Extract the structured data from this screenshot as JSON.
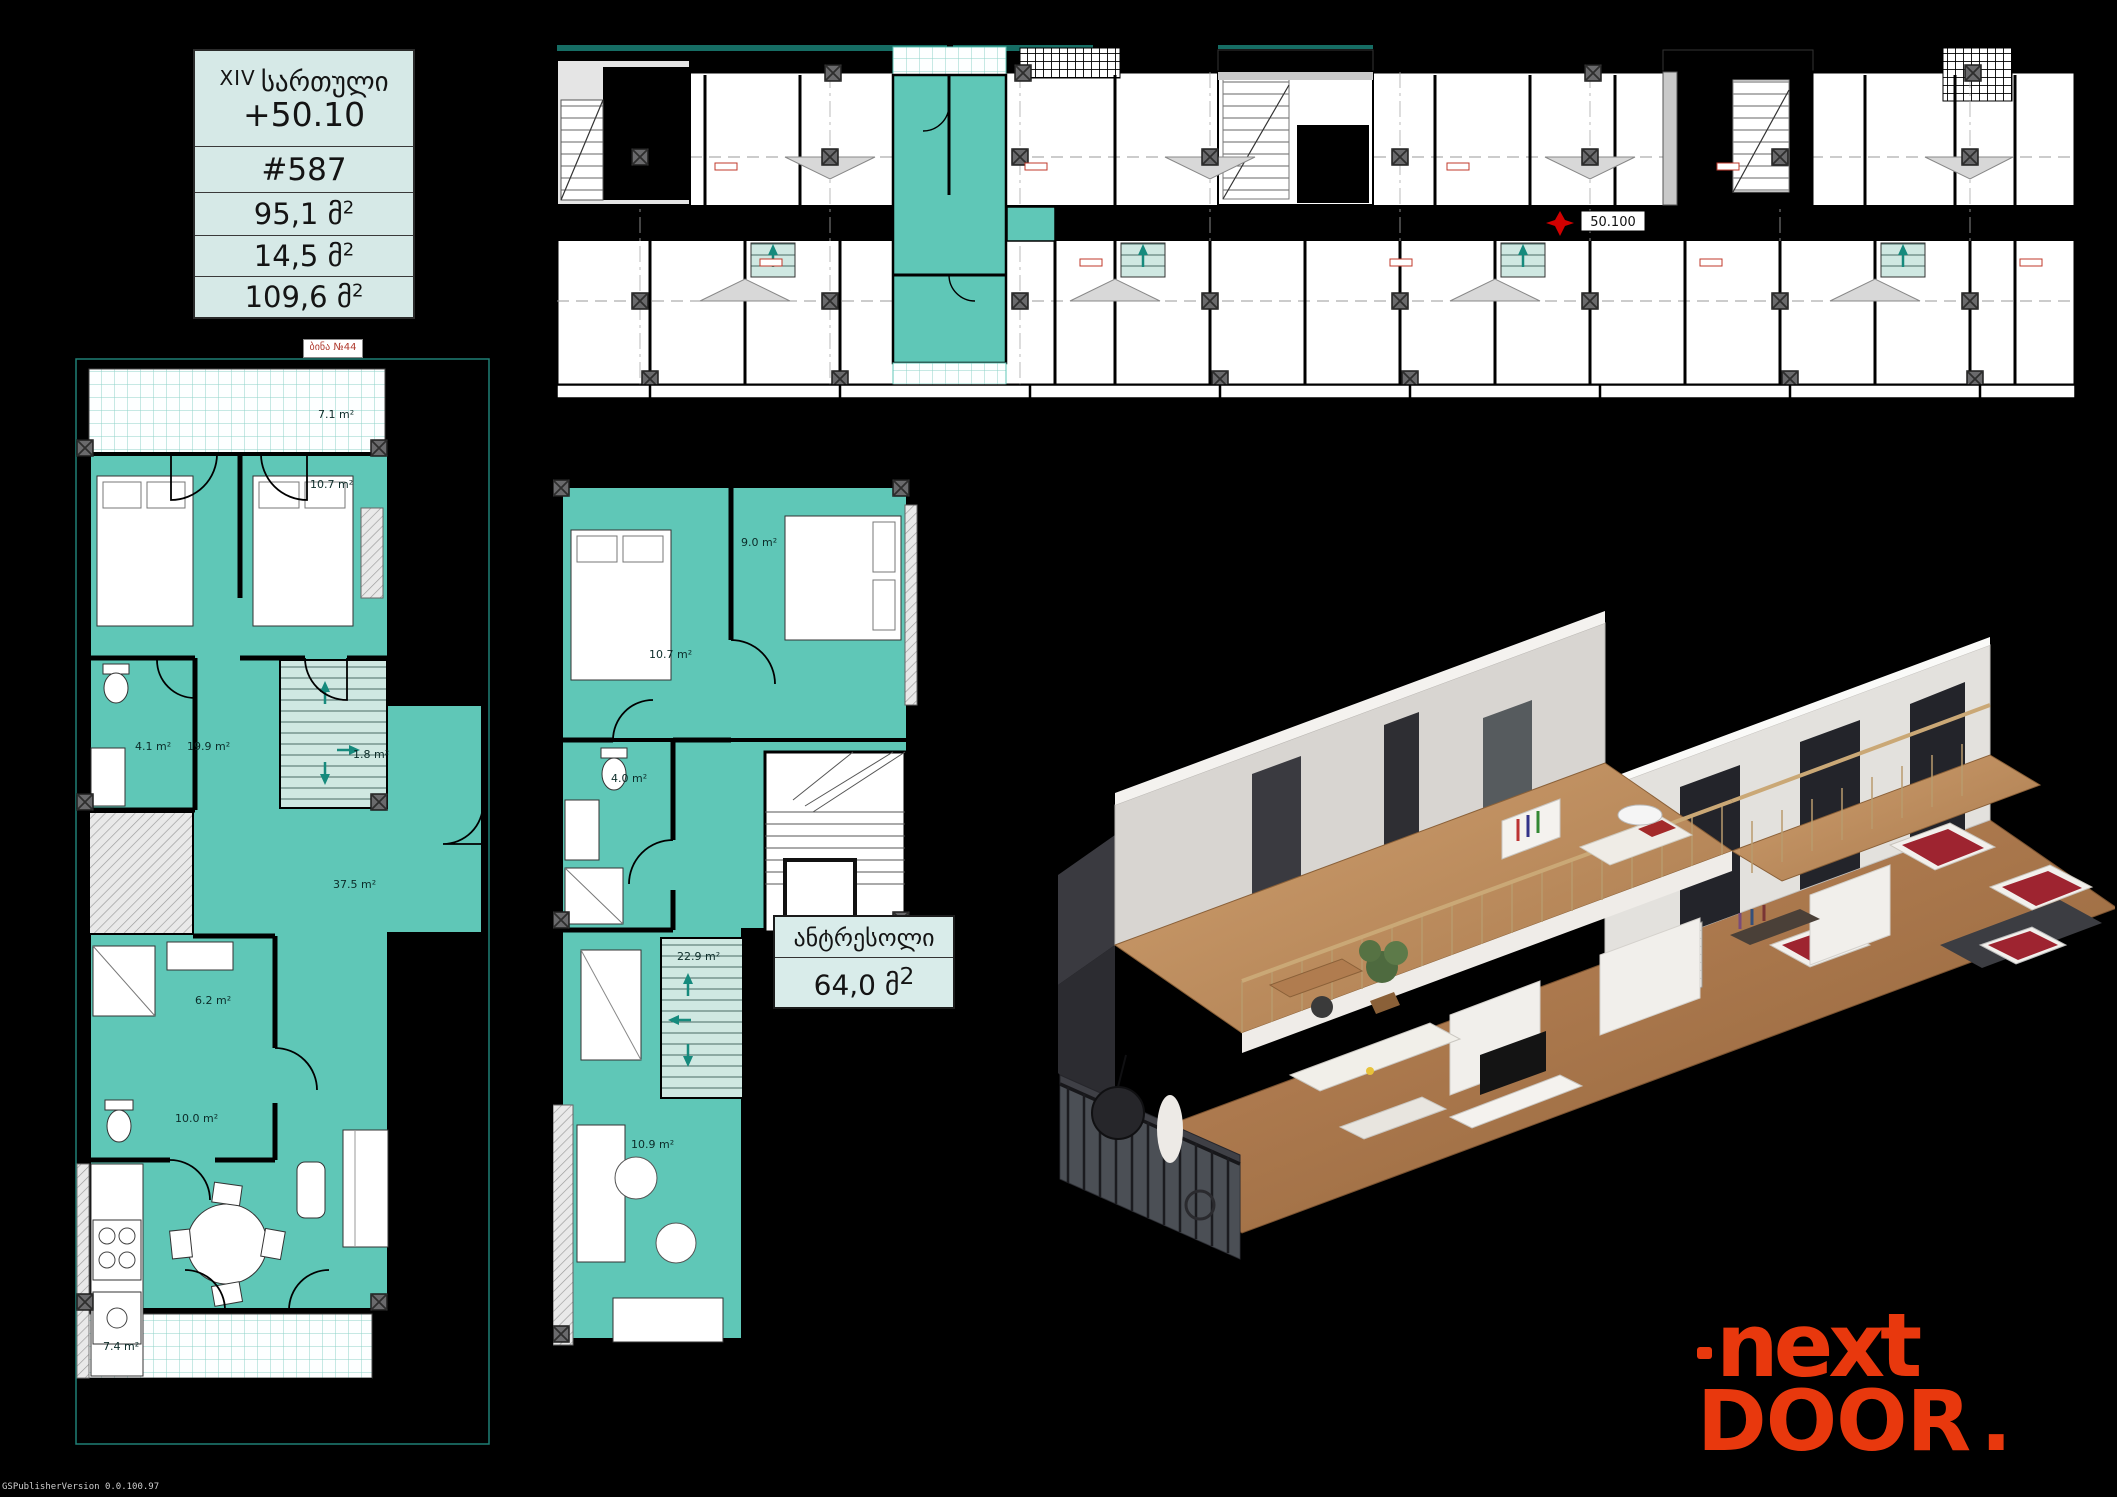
{
  "colors": {
    "background": "#000000",
    "unit_teal": "#5fc7b7",
    "unit_teal_light": "#cfe8e2",
    "table_bg": "#d6e9e7",
    "accent_red": "#e8380d",
    "plan_outline_teal": "#1f7f75",
    "wood": "#b5835a"
  },
  "units": {
    "sqm_geo": " მ",
    "sup": "2"
  },
  "info_table": {
    "floor_prefix": "XIV",
    "floor_word": "სართული",
    "elevation": "+50.10",
    "apartment": "#587",
    "area_main": "95,1",
    "area_secondary": "14,5",
    "area_total": "109,6"
  },
  "apartment_tag": {
    "text": "ბინა №44"
  },
  "top_plan": {
    "elevation_mark": "50.100"
  },
  "left_plan": {
    "areas": {
      "balcony_top": "7.1 m²",
      "bedroom_right": "10.7 m²",
      "bathroom": "4.1 m²",
      "hall": "19.9 m²",
      "stairs": "1.8 m²",
      "living": "37.5 m²",
      "wc": "6.2 m²",
      "kitchen": "10.0 m²",
      "balcony_bottom": "7.4 m²"
    }
  },
  "mezzanine_plan": {
    "areas": {
      "bedroom_left": "10.7 m²",
      "bedroom_right": "9.0 m²",
      "bathroom": "4.0 m²",
      "hall": "22.9 m²",
      "room": "10.9 m²"
    }
  },
  "mezzanine_label": {
    "title": "ანტრესოლი",
    "value": "64,0"
  },
  "logo": {
    "line1": "next",
    "line2": "DOOR",
    "dot": "."
  },
  "watermark": {
    "text": "GSPublisherVersion 0.0.100.97"
  }
}
